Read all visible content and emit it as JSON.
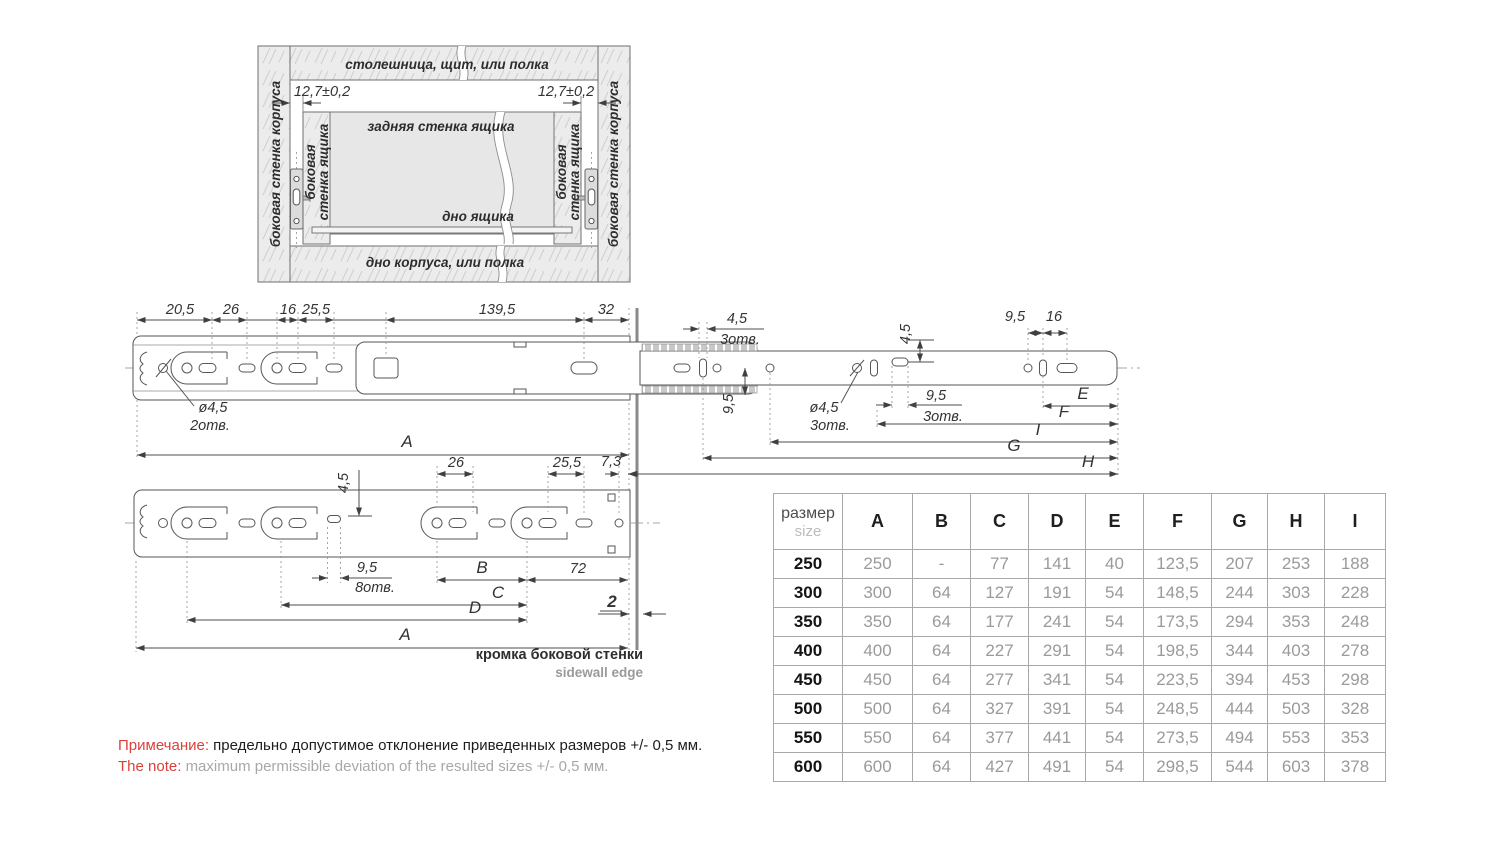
{
  "cabinet": {
    "top_panel": "столешница, щит, или полка",
    "bottom_panel": "дно корпуса, или полка",
    "cabinet_sidewall": "боковая стенка корпуса",
    "drawer_sidewall_line1": "боковая",
    "drawer_sidewall_line2": "стенка ящика",
    "drawer_back": "задняя стенка ящика",
    "drawer_bottom": "дно ящика",
    "gap": "12,7±0,2"
  },
  "dims": {
    "d20_5": "20,5",
    "d26": "26",
    "d16": "16",
    "d25_5": "25,5",
    "d139_5": "139,5",
    "d32": "32",
    "d4_5": "4,5",
    "d9_5": "9,5",
    "d7_3": "7,3",
    "d72": "72",
    "d2": "2",
    "dia4_5": "ø4,5",
    "holes2": "2отв.",
    "holes3": "3отв.",
    "holes8": "8отв.",
    "A": "A",
    "B": "B",
    "C": "C",
    "D": "D",
    "E": "E",
    "F": "F",
    "G": "G",
    "H": "H",
    "I": "I"
  },
  "edge": {
    "ru": "кромка боковой стенки",
    "en": "sidewall edge"
  },
  "table": {
    "header_ru": "размер",
    "header_en": "size",
    "columns": [
      "A",
      "B",
      "C",
      "D",
      "E",
      "F",
      "G",
      "H",
      "I"
    ],
    "rows": [
      {
        "size": "250",
        "values": [
          "250",
          "-",
          "77",
          "141",
          "40",
          "123,5",
          "207",
          "253",
          "188"
        ]
      },
      {
        "size": "300",
        "values": [
          "300",
          "64",
          "127",
          "191",
          "54",
          "148,5",
          "244",
          "303",
          "228"
        ]
      },
      {
        "size": "350",
        "values": [
          "350",
          "64",
          "177",
          "241",
          "54",
          "173,5",
          "294",
          "353",
          "248"
        ]
      },
      {
        "size": "400",
        "values": [
          "400",
          "64",
          "227",
          "291",
          "54",
          "198,5",
          "344",
          "403",
          "278"
        ]
      },
      {
        "size": "450",
        "values": [
          "450",
          "64",
          "277",
          "341",
          "54",
          "223,5",
          "394",
          "453",
          "298"
        ]
      },
      {
        "size": "500",
        "values": [
          "500",
          "64",
          "327",
          "391",
          "54",
          "248,5",
          "444",
          "503",
          "328"
        ]
      },
      {
        "size": "550",
        "values": [
          "550",
          "64",
          "377",
          "441",
          "54",
          "273,5",
          "494",
          "553",
          "353"
        ]
      },
      {
        "size": "600",
        "values": [
          "600",
          "64",
          "427",
          "491",
          "54",
          "298,5",
          "544",
          "603",
          "378"
        ]
      }
    ]
  },
  "note": {
    "label_ru": "Примечание:",
    "text_ru": "предельно допустимое отклонение приведенных размеров +/- 0,5 мм.",
    "label_en": "The note:",
    "text_en": "maximum permissible deviation of the resulted sizes +/- 0,5 мм."
  },
  "colors": {
    "accent_red": "#d9423b",
    "line": "#565656",
    "muted": "#9a9a9a"
  }
}
